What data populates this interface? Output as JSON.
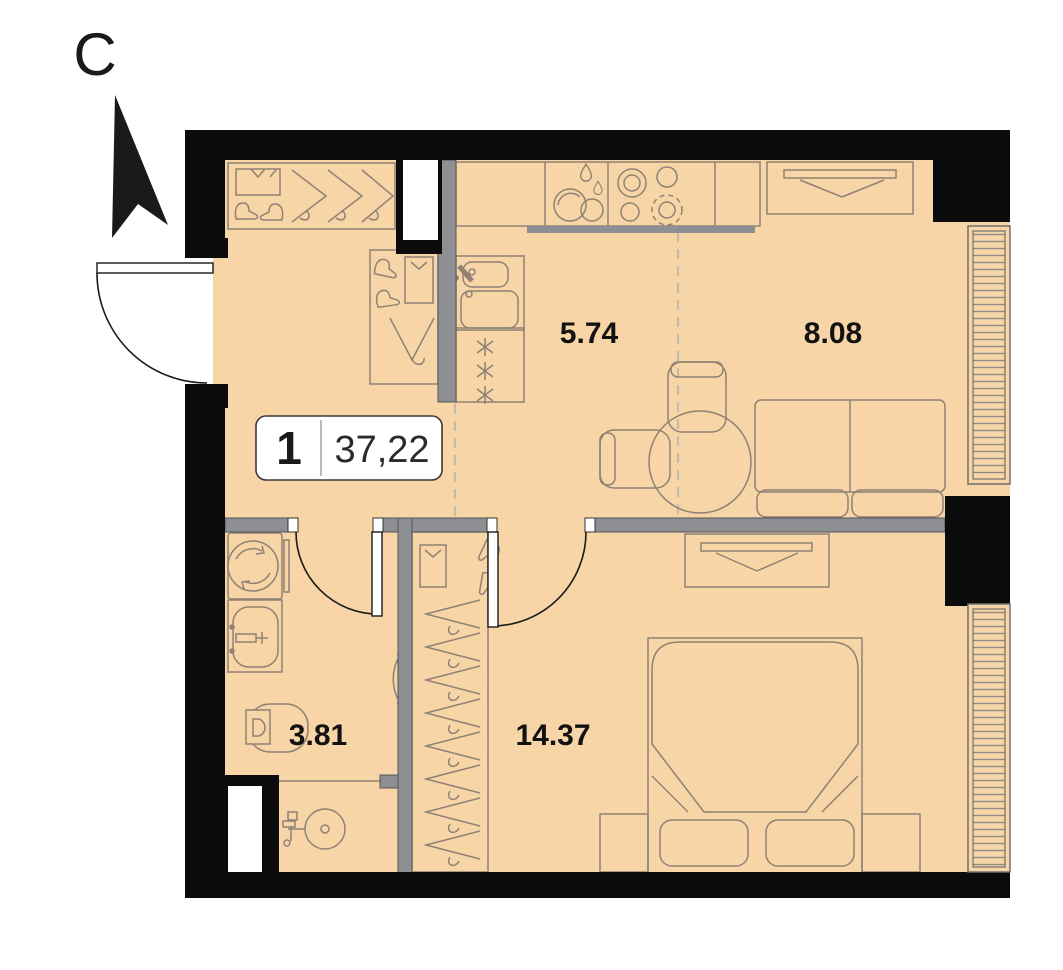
{
  "plan_title": "apartment-floor-plan",
  "north": {
    "label": "С"
  },
  "unit_badge": {
    "rooms": "1",
    "area": "37,22"
  },
  "rooms": [
    {
      "id": "kitchen",
      "area_label": "5.74"
    },
    {
      "id": "living-room",
      "area_label": "8.08"
    },
    {
      "id": "bathroom",
      "area_label": "3.81"
    },
    {
      "id": "bedroom",
      "area_label": "14.37"
    }
  ],
  "furniture_icons": [
    "entry-wardrobe-icon",
    "shirt-box-icon",
    "boots-icon",
    "hanger-icon",
    "kitchen-counter-icon",
    "dish-rack-icon",
    "stove-icon",
    "kitchen-sink-icon",
    "fridge-icon",
    "dining-table-icon",
    "chair-icon",
    "sofa-icon",
    "tv-icon",
    "radiator-icon",
    "washing-machine-icon",
    "bathroom-sink-icon",
    "toilet-icon",
    "shower-icon",
    "closet-hangers-icon",
    "bed-icon",
    "nightstand-icon",
    "north-arrow-icon",
    "entrance-door-icon",
    "interior-door-icon",
    "vent-shaft-icon",
    "zone-dashed-line"
  ],
  "colors": {
    "floor": "#f7d5a6",
    "wall_black": "#0b0b0b",
    "wall_gray": "#8e8f93",
    "furniture_line": "#8f8275",
    "zone_dash": "#c2bbae",
    "label_text": "#121212",
    "badge_bg": "#ffffff"
  }
}
